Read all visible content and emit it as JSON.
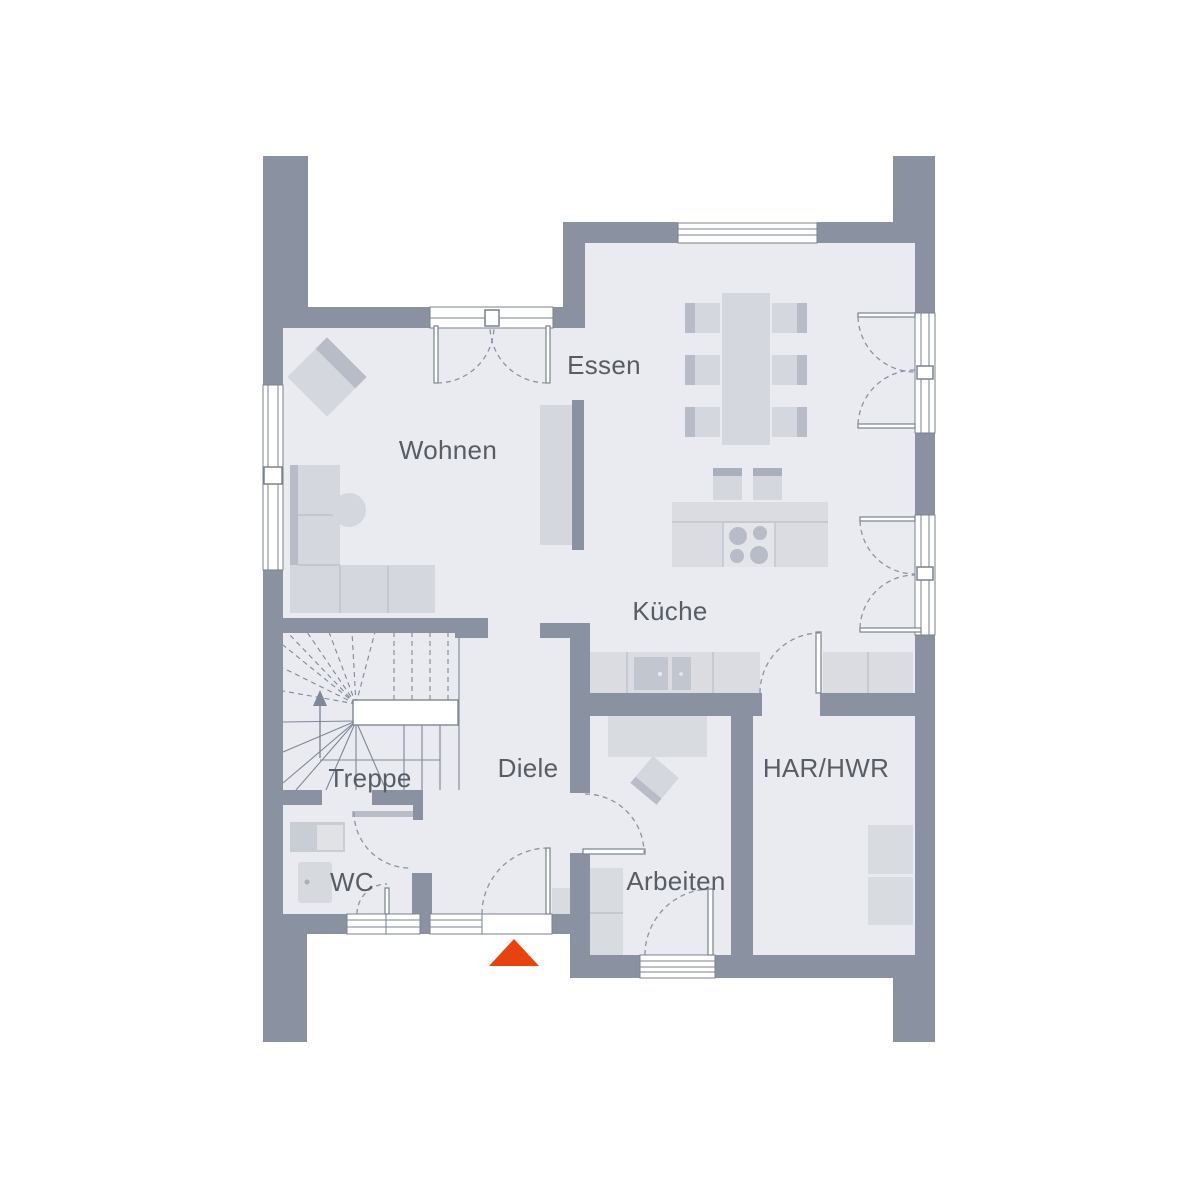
{
  "colors": {
    "wall": "#8a91a1",
    "floor": "#e9ebf0",
    "outline": "#79828f",
    "line": "#7f8897",
    "swing": "#8a93a3",
    "furniture": "#d4d7dd",
    "furnitureDark": "#b7bcc6",
    "counter": "#dadce1",
    "appliance": "#c2c7cf",
    "shelf": "#d8dbe0",
    "inset": "#c9cdd4",
    "divider": "#b9bec8",
    "text": "#575c65",
    "accent": "#e8430f"
  },
  "rooms": [
    {
      "id": "wohnen",
      "label": "Wohnen"
    },
    {
      "id": "essen",
      "label": "Essen"
    },
    {
      "id": "kueche",
      "label": "Küche"
    },
    {
      "id": "treppe",
      "label": "Treppe"
    },
    {
      "id": "diele",
      "label": "Diele"
    },
    {
      "id": "wc",
      "label": "WC"
    },
    {
      "id": "arbeiten",
      "label": "Arbeiten"
    },
    {
      "id": "har_hwr",
      "label": "HAR/HWR"
    }
  ],
  "entrance": {
    "marker": "entrance-triangle"
  }
}
